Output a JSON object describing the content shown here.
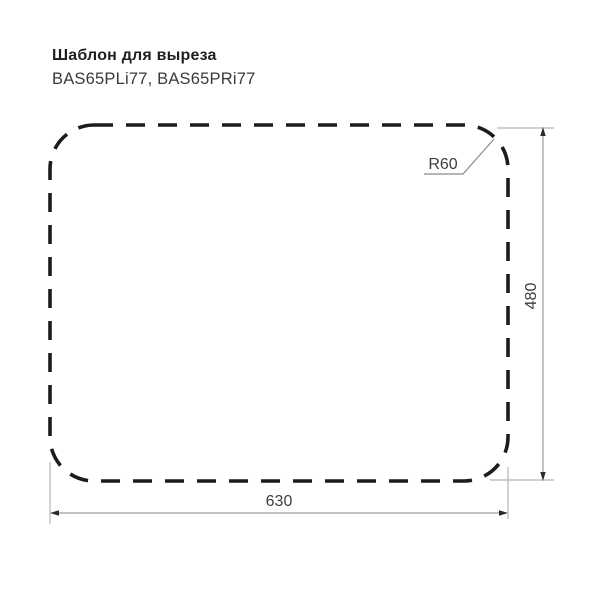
{
  "page": {
    "title": "Шаблон для выреза",
    "subtitle": "BAS65PLi77, BAS65PRi77"
  },
  "drawing": {
    "type": "cutout-template-technical-drawing",
    "shape": "dashed-rounded-rectangle",
    "dimensions": {
      "width": 630,
      "height": 480,
      "corner_radius": 60
    },
    "labels": {
      "width": "630",
      "height": "480",
      "radius": "R60"
    },
    "colors": {
      "outline": "#1c1c1c",
      "dimension_line": "#9a9a9a",
      "extension_line": "#b5b5b5",
      "leader_line": "#8a8a8a",
      "arrowhead": "#2a2a2a",
      "text": "#3c3c3c",
      "background": "#ffffff"
    }
  }
}
